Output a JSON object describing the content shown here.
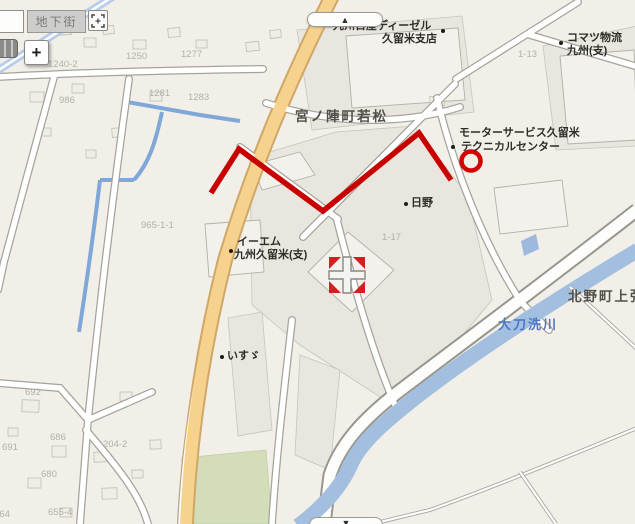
{
  "controls": {
    "underground_button": "地下街",
    "zoom_in_button": "+",
    "pan_up_symbol": "▲",
    "pan_down_symbol": "▼"
  },
  "map": {
    "area_labels": {
      "miyanojin": "宮ノ陣町若松",
      "kitano": "北野町上弥"
    },
    "river_label": "大刀洗川",
    "pois": {
      "nissan": {
        "line1": "九州日産ディーゼル",
        "line2": "久留米支店"
      },
      "komatsu": {
        "line1": "コマツ物流",
        "line2": "九州(支)"
      },
      "motor": {
        "line1": "モーターサービス久留米",
        "line2": "テクニカルセンター"
      },
      "hino": {
        "label": "日野"
      },
      "em": {
        "line1": "イーエム",
        "line2": "九州久留米(支)"
      },
      "isuzu": {
        "label": "いすゞ"
      }
    },
    "lot_numbers": {
      "n1240_2": "1240-2",
      "n1250": "1250",
      "n1277": "1277",
      "n986": "986",
      "n1281": "1281",
      "n1283": "1283",
      "n1_13": "1-13",
      "n1_17": "1-17",
      "n965_1_1": "965-1-1",
      "n692": "692",
      "n691": "691",
      "n686": "686",
      "n680": "680",
      "n204_2": "204-2",
      "n655_4": "655-4",
      "n664": "664"
    },
    "colors": {
      "route_red": "#c80000",
      "river_blue": "#a2bfe0",
      "main_road_yellow": "#f6d28e",
      "canal_blue": "#7fa8d8",
      "park_green": "#d3ddb9"
    }
  }
}
